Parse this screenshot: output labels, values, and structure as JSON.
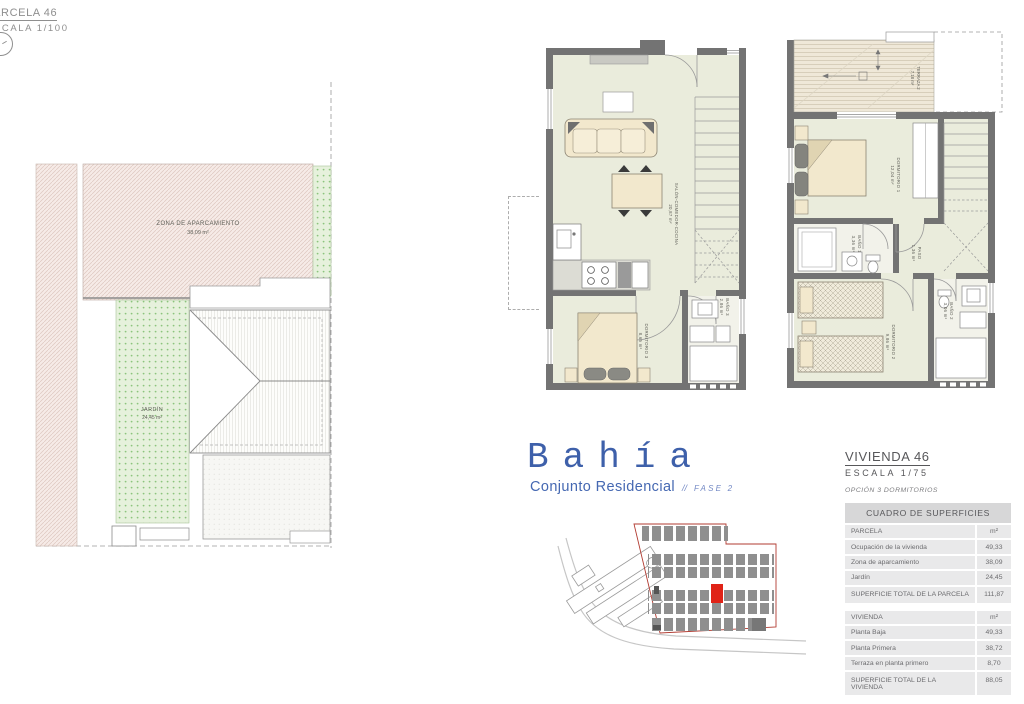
{
  "header": {
    "parcel_title": "PARCELA 46",
    "parcel_scale": "ESCALA 1/100"
  },
  "site_plan": {
    "parking": {
      "label": "ZONA DE APARCAMIENTO",
      "area": "38,09 m²"
    },
    "garden": {
      "label": "JARDÍN",
      "area": "24,45 m²"
    }
  },
  "floor_plans": {
    "ground": {
      "salon": {
        "label": "SALÓN-COMEDOR-COCINA",
        "area": "20,87 m²"
      },
      "dorm3": {
        "label": "DORMITORIO 3",
        "area": "8,65 m²"
      },
      "bano3": {
        "label": "BAÑO 3",
        "area": "2,86 m²"
      }
    },
    "first": {
      "terraza": {
        "label": "TERRAZA 2",
        "area": "7,18 m²"
      },
      "dorm1": {
        "label": "DORMITORIO 1",
        "area": "12,04 m²"
      },
      "bano1": {
        "label": "BAÑO 1",
        "area": "3,36 m²"
      },
      "paso": {
        "label": "PASO",
        "area": "1,36 m²"
      },
      "dorm2": {
        "label": "DORMITORIO 2",
        "area": "9,86 m²"
      },
      "bano2": {
        "label": "BAÑO 2",
        "area": "3,06 m²"
      }
    }
  },
  "brand": {
    "name": "Bahía",
    "subtitle": "Conjunto Residencial",
    "separator": "//",
    "phase": "FASE 2",
    "color": "#3e60aa"
  },
  "unit_panel": {
    "title": "VIVIENDA 46",
    "scale": "ESCALA 1/75",
    "option": "OPCIÓN 3 DORMITORIOS",
    "table": {
      "header": "CUADRO DE SUPERFICIES",
      "rows": [
        {
          "label": "PARCELA",
          "value": "m²",
          "type": "section"
        },
        {
          "label": "Ocupación de la vivienda",
          "value": "49,33",
          "type": "item"
        },
        {
          "label": "Zona de aparcamiento",
          "value": "38,09",
          "type": "item"
        },
        {
          "label": "Jardín",
          "value": "24,45",
          "type": "item"
        },
        {
          "label": "SUPERFICIE TOTAL DE LA PARCELA",
          "value": "111,87",
          "type": "total"
        },
        {
          "label": "VIVIENDA",
          "value": "m²",
          "type": "section"
        },
        {
          "label": "Planta Baja",
          "value": "49,33",
          "type": "item"
        },
        {
          "label": "Planta Primera",
          "value": "38,72",
          "type": "item"
        },
        {
          "label": "Terraza en planta primero",
          "value": "8,70",
          "type": "item"
        },
        {
          "label": "SUPERFICIE TOTAL DE LA VIVIENDA",
          "value": "88,05",
          "type": "total"
        }
      ]
    }
  },
  "colors": {
    "wall": "#737373",
    "floor": "#eaecdc",
    "parking_pink": "#f6ebe7",
    "garden_green": "#e6f1dc",
    "selected_unit_red": "#e02317",
    "boundary_red": "#b23b31",
    "brand_blue": "#3e60aa"
  }
}
